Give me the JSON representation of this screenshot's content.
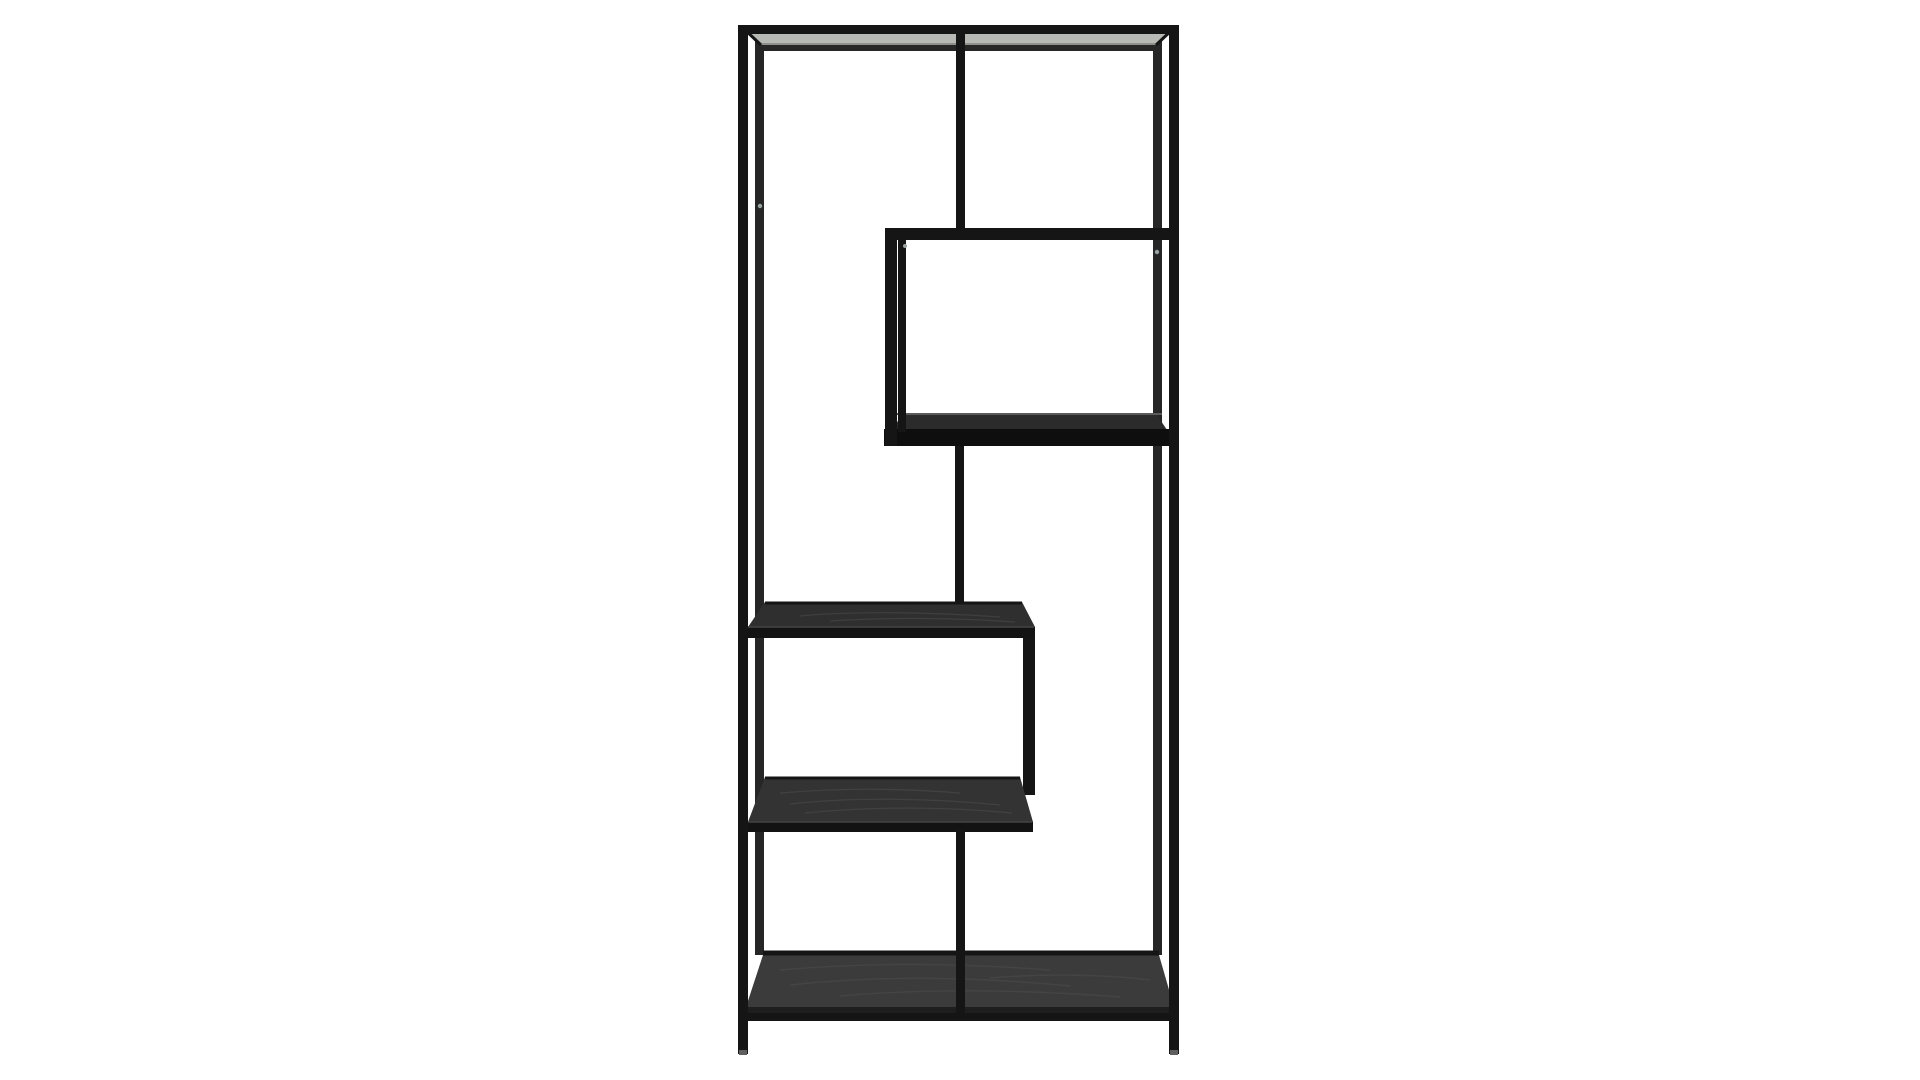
{
  "scene": {
    "alt": "Black metal asymmetric etagere bookcase with staggered black wood shelves on a plain white studio background",
    "background": "#ffffff"
  },
  "product": {
    "type": "open etagere bookcase",
    "frame_finish": "matte black metal",
    "shelf_finish": "black ash wood grain",
    "shelf_levels": 5,
    "visible_legs": 2,
    "layout_style": "asymmetric zig-zag open shelving"
  },
  "colors": {
    "frame": "#151515",
    "frame_soft": "#262626",
    "top_sheen": "#b7b9b4",
    "sheen_shadow": "#8d908b",
    "wood_box": "#2b2b2b",
    "wood_middle": "#2f2f2f",
    "wood_lower": "#333333",
    "wood_bottom": "#3b3b3b",
    "wood_face": "#0e0e0e",
    "wood_face2": "#131313",
    "face_light": "#1e1e1e",
    "edge_highlight": "#5a5a5a",
    "edge_soft": "#454545",
    "grain": "#4d4d4d",
    "screw_dot": "#9aa3a3",
    "foot_tip": "#5f5f5f"
  }
}
